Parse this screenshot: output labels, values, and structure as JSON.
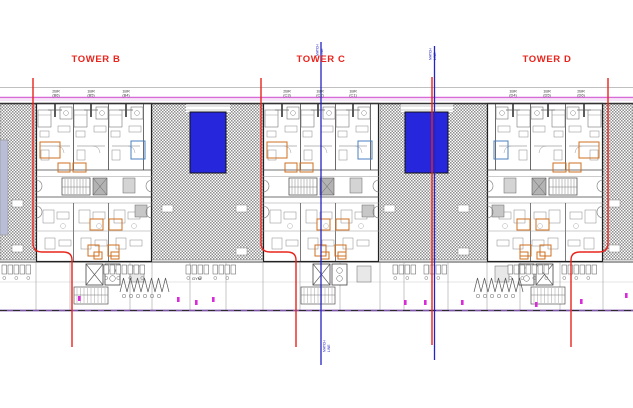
{
  "drawing": {
    "towers": [
      {
        "name": "TOWER B",
        "units": [
          {
            "type": "2BR",
            "id": "(B6)"
          },
          {
            "type": "1BR",
            "id": "(B5)"
          },
          {
            "type": "1BR",
            "id": "(B4)"
          }
        ]
      },
      {
        "name": "TOWER C",
        "units": [
          {
            "type": "2BR",
            "id": "(C3)"
          },
          {
            "type": "1BR",
            "id": "(C2)"
          },
          {
            "type": "1BR",
            "id": "(C1)"
          }
        ]
      },
      {
        "name": "TOWER D",
        "units": [
          {
            "type": "1BR",
            "id": "(D4)"
          },
          {
            "type": "1BR",
            "id": "(D5)"
          },
          {
            "type": "2BR",
            "id": "(D6)"
          }
        ]
      }
    ],
    "labels": {
      "match_line": "MATCH LINE",
      "gym": "GYM"
    },
    "colors": {
      "accent_red": "#e8241c",
      "match_blue": "#2424c0",
      "pool_blue": "#2626dc",
      "boundary_magenta": "#d76bd7",
      "boundary_magenta_light": "#edb6ed",
      "setback_purple": "#7e57a8",
      "hatch_gray": "#8e8e8e",
      "line_dark": "#3c3c3c",
      "line_mid": "#666666",
      "line_light": "#999999",
      "highlight_orange": "#cf6f22",
      "highlight_blue": "#4a7fc1",
      "door_magenta": "#d92bd9"
    }
  }
}
